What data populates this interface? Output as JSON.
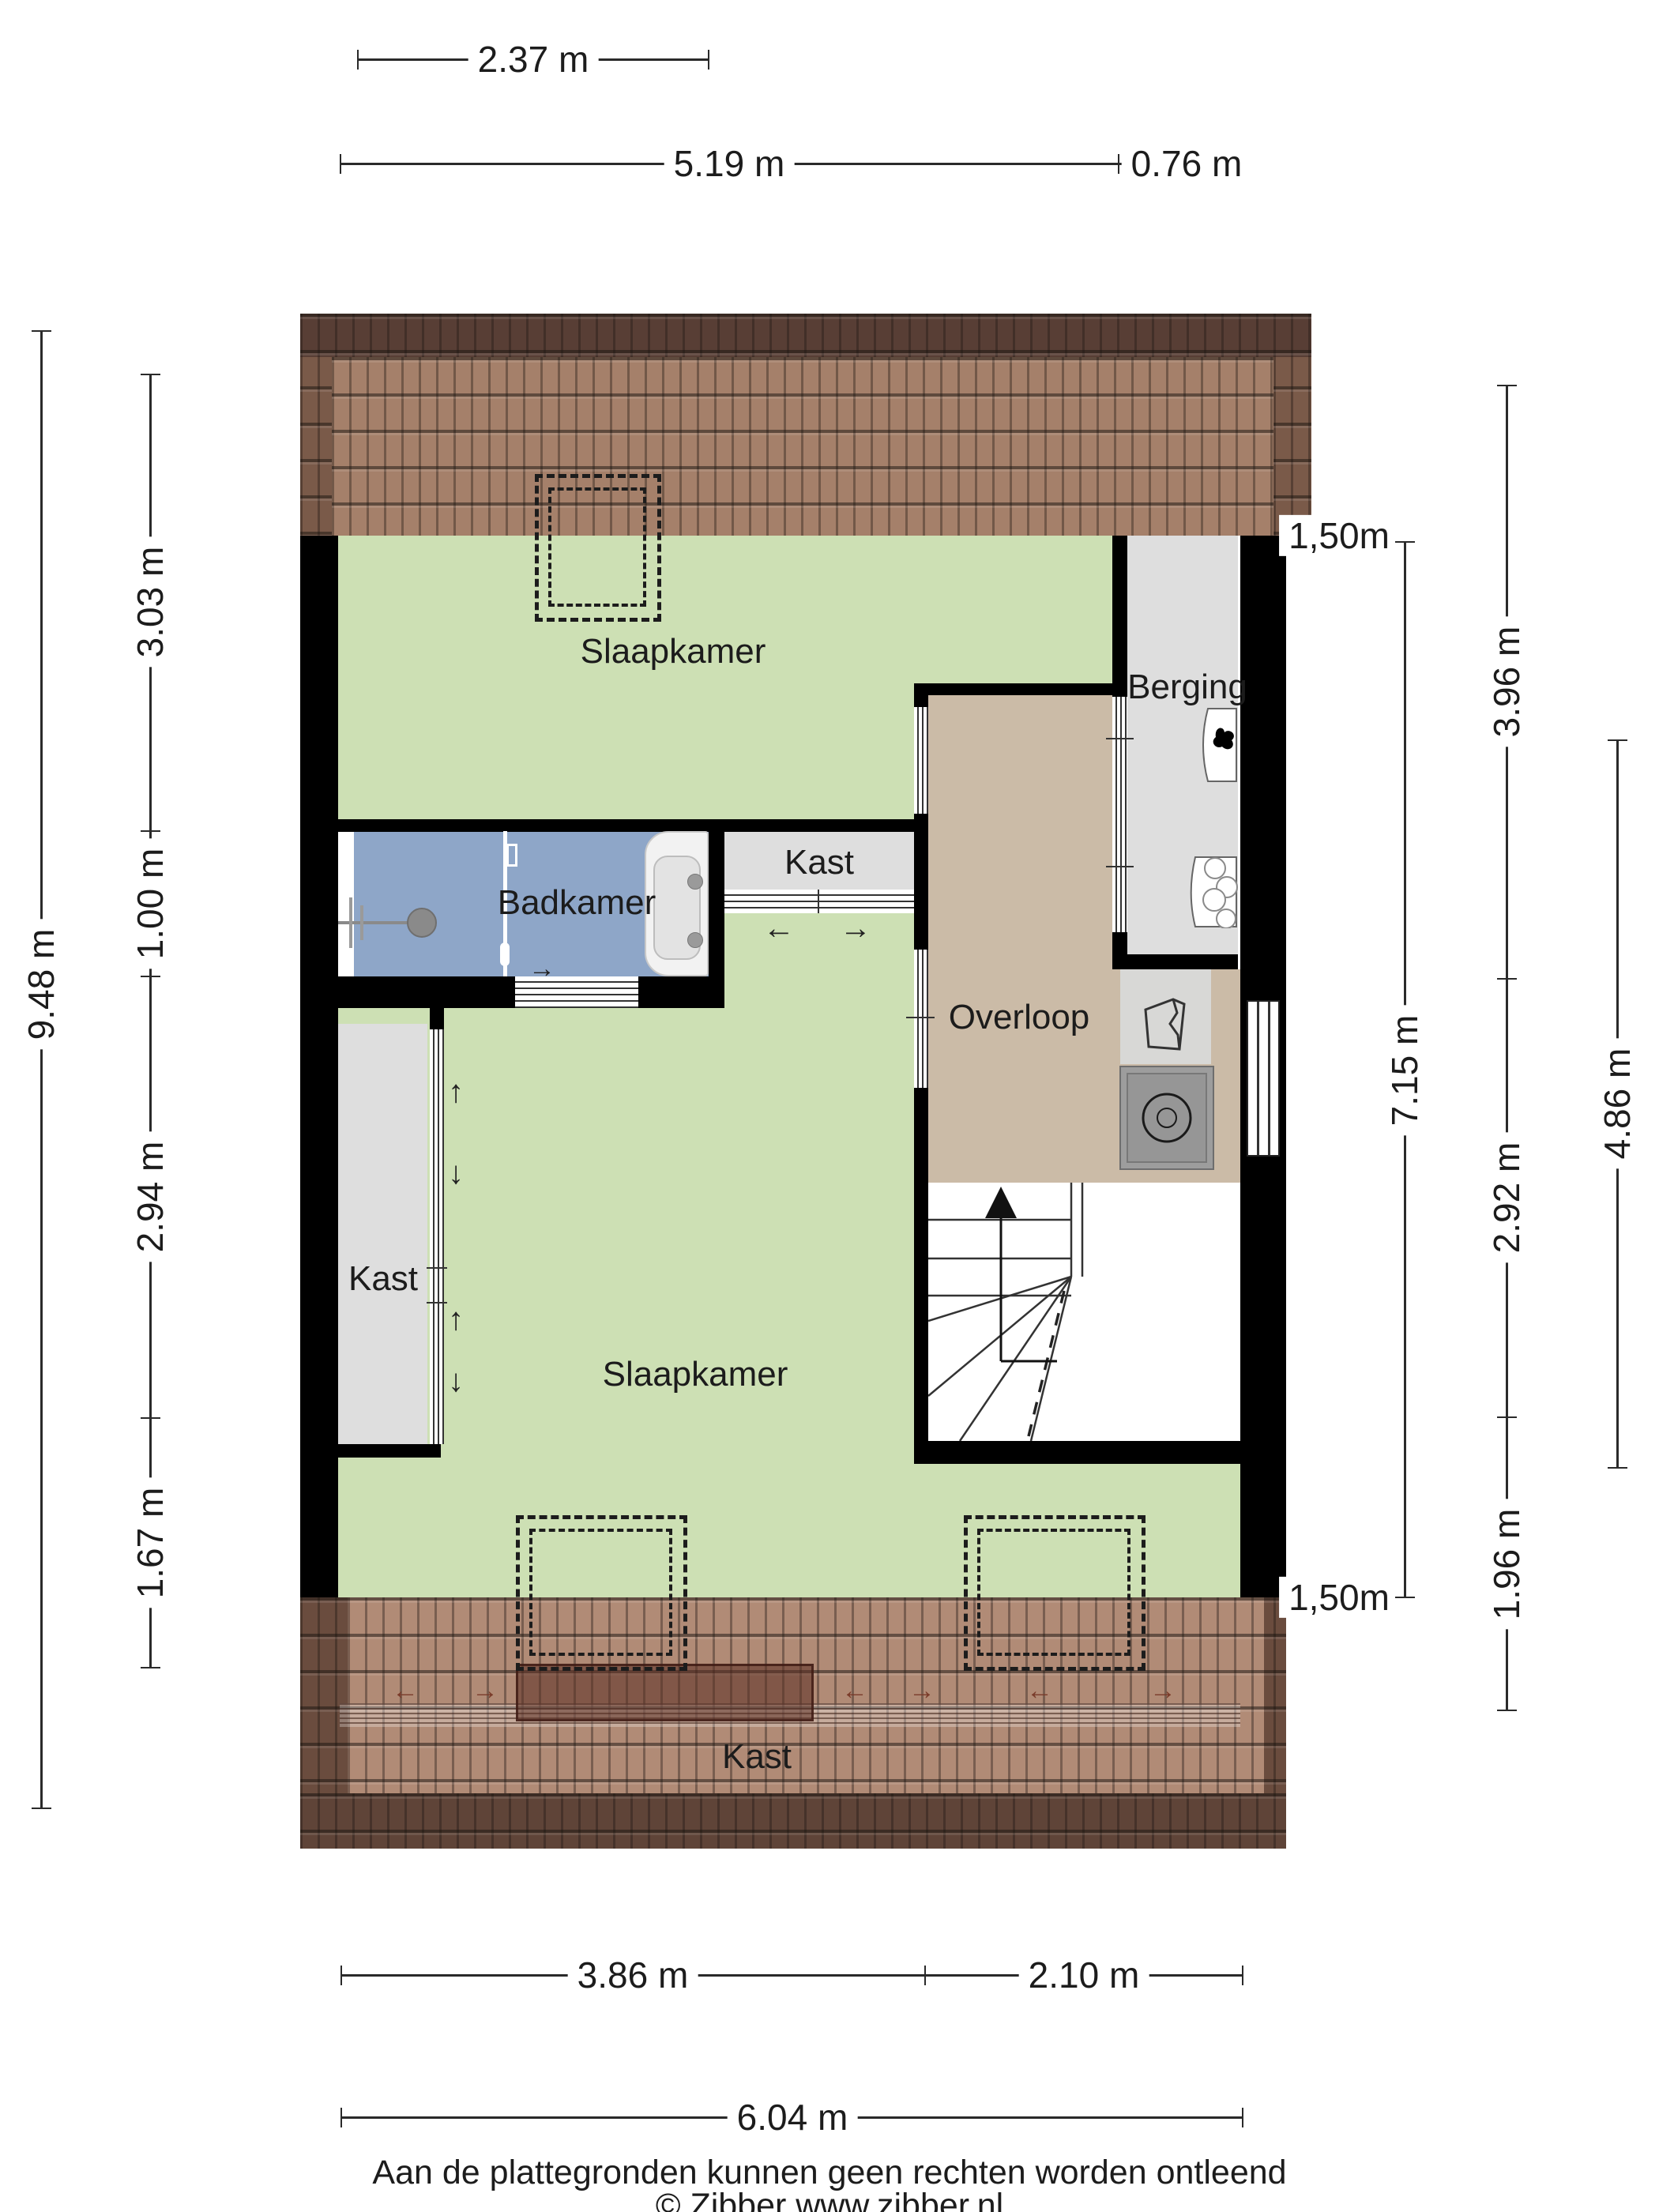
{
  "rooms": {
    "bedroom_top": "Slaapkamer",
    "bathroom": "Badkamer",
    "closet_top": "Kast",
    "closet_left": "Kast",
    "closet_attic": "Kast",
    "storage": "Berging",
    "landing": "Overloop",
    "bedroom_main": "Slaapkamer"
  },
  "dimensions": {
    "top": {
      "small_width": "2.37 m",
      "main_width": "5.19 m",
      "right_width": "0.76 m"
    },
    "left": {
      "total_height": "9.48 m",
      "seg1": "3.03 m",
      "seg2": "1.00 m",
      "seg3": "2.94 m",
      "seg4": "1.67 m"
    },
    "right": {
      "headroom_top": "1,50m",
      "inner_height": "7.15 m",
      "seg1": "3.96 m",
      "seg2": "2.92 m",
      "seg3": "1.96 m",
      "outer_height": "4.86 m",
      "headroom_bottom": "1,50m"
    },
    "bottom": {
      "seg1": "3.86 m",
      "seg2": "2.10 m",
      "total_width": "6.04 m"
    }
  },
  "footer": {
    "disclaimer": "Aan de plattegronden kunnen geen rechten worden ontleend",
    "credit": "© Zibber www.zibber.nl"
  },
  "glyphs": {
    "arrow_up": "↑",
    "arrow_down": "↓",
    "arrow_left": "←",
    "arrow_right": "→"
  },
  "colors": {
    "floor_green": "#cde0b4",
    "floor_tan": "#cbbba7",
    "floor_blue": "#8ea6c8",
    "floor_gray": "#dedede",
    "wall": "#000000",
    "roof_dark": "#583e35",
    "roof_mid": "#7a5a49",
    "roof_light": "#a5806a",
    "roof_light_bottom": "#b18b76",
    "dim_line": "#2a2a2a",
    "text": "#1c1c1c"
  }
}
